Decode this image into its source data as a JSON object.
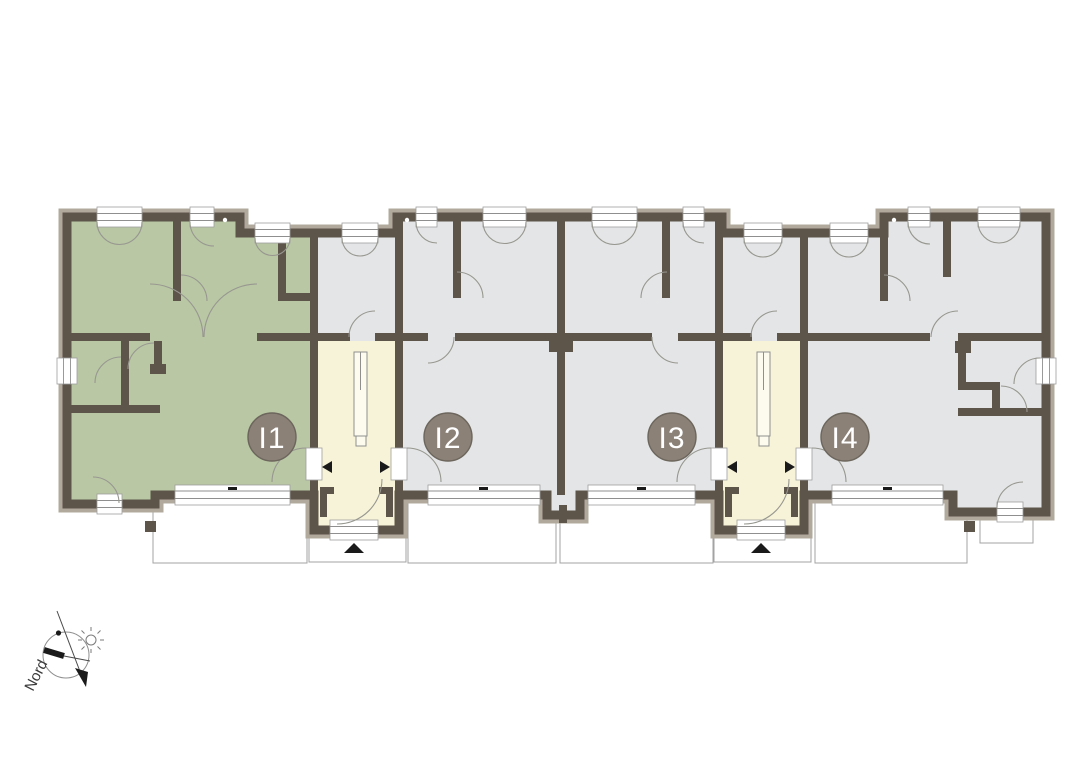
{
  "canvas": {
    "width": 1076,
    "height": 780
  },
  "units": [
    {
      "label": "I1",
      "color": "#b9c7a4",
      "highlighted": true
    },
    {
      "label": "I2",
      "color": "#e4e5e6",
      "highlighted": false
    },
    {
      "label": "I3",
      "color": "#e4e5e6",
      "highlighted": false
    },
    {
      "label": "I4",
      "color": "#e4e5e6",
      "highlighted": false
    }
  ],
  "badge": {
    "fill": "#8b8177",
    "stroke": "#6c665d",
    "text_color": "#ffffff"
  },
  "colors": {
    "wall": "#5d544a",
    "wall_band": "#b2a99d",
    "unit_gray": "#e4e5e6",
    "unit_highlight": "#b9c7a4",
    "stairwell": "#f7f3d8",
    "background": "#ffffff"
  },
  "compass": {
    "label": "Nord"
  }
}
